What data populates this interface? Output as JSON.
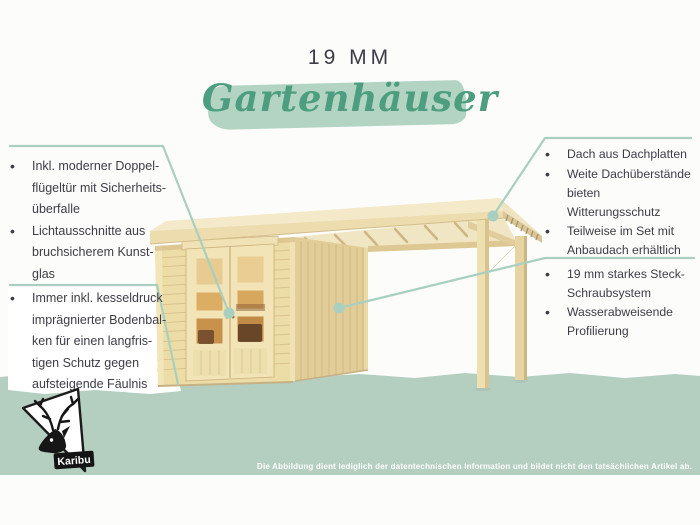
{
  "header": {
    "size_label": "19 MM",
    "title": "Gartenhäuser"
  },
  "callouts": {
    "left_top": {
      "bullets": [
        "Inkl. moderner Doppel-\nflügeltür mit Sicherheits-\nüberfalle",
        "Lichtausschnitte aus\nbruchsicherem Kunst-\nglas"
      ]
    },
    "left_bottom": {
      "bullets": [
        "Immer inkl. kesseldruck\nimprägnierter Bodenbal-\nken für einen langfris-\ntigen Schutz gegen\naufsteigende Fäulnis"
      ]
    },
    "right_top": {
      "bullets": [
        "Dach aus Dachplatten",
        "Weite Dachüberstände\nbieten Witterungsschutz",
        "Teilweise im Set mit\nAnbaudach erhältlich"
      ]
    },
    "right_bottom": {
      "bullets": [
        "19 mm starkes Steck-\nSchraubsystem",
        "Wasserabweisende\nProfilierung"
      ]
    }
  },
  "illustration": {
    "label": "Holz-Gartenhaus mit Flachdach, Doppelflügeltür und Anbaudach"
  },
  "logo": {
    "brand": "Karibu"
  },
  "footer": {
    "disclaimer": "Die Abbildung dient lediglich der datentechnischen Information und bildet nicht den tatsächlichen Artikel ab."
  },
  "colors": {
    "accent_green": "#4d9e80",
    "band_green": "#b4cec0",
    "brush_green": "#b3d4c2",
    "callout_teal": "#a9cfc1",
    "text_dark": "#3d3d47",
    "wood_light": "#ecdca6",
    "wood_dark": "#e2cd98"
  }
}
